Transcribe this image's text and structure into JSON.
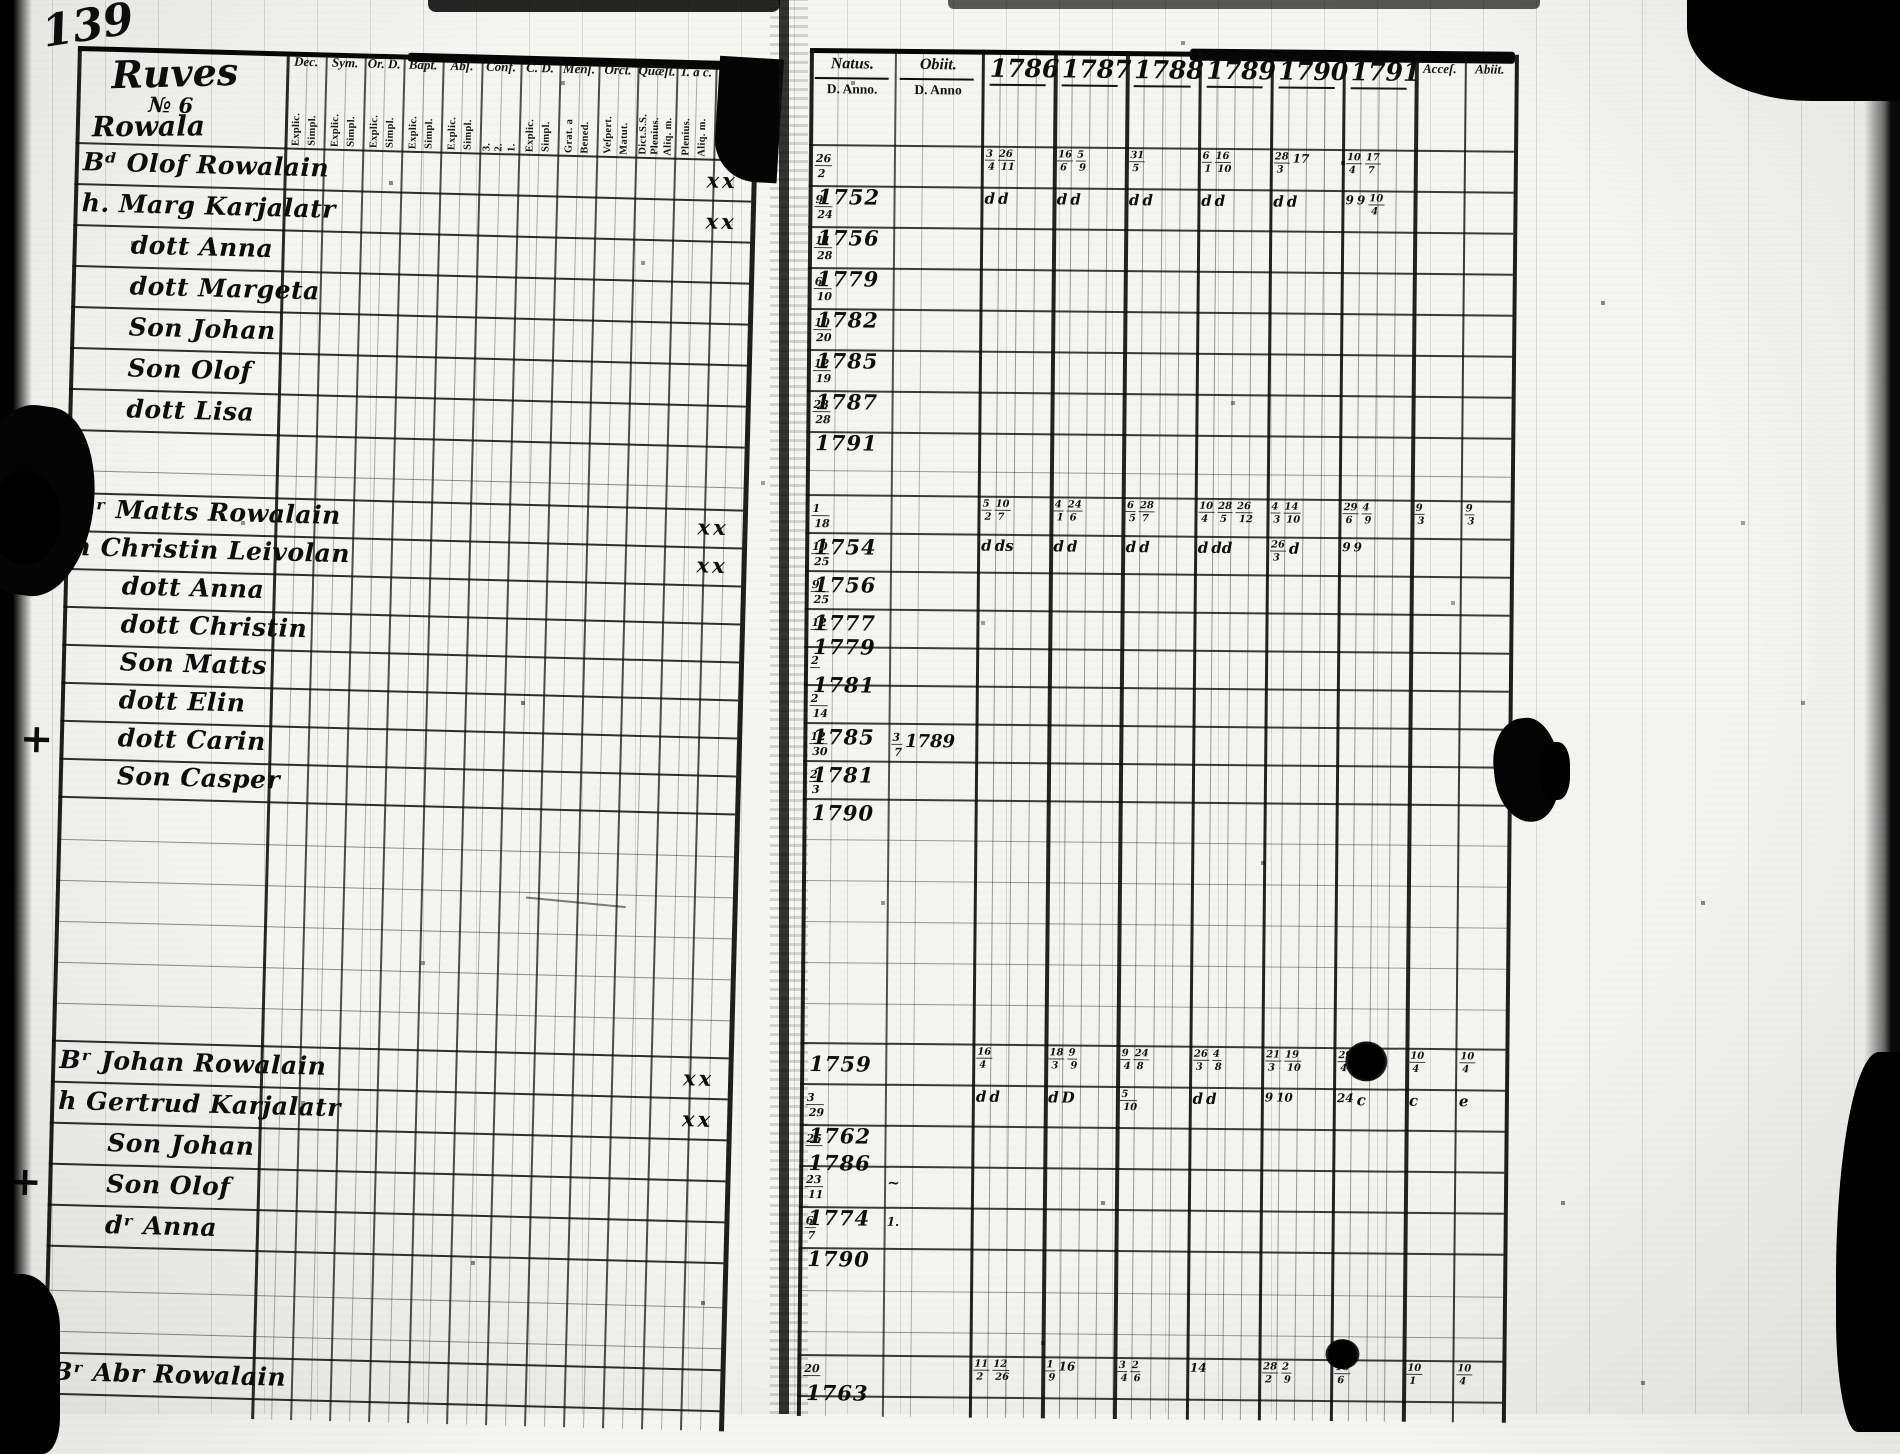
{
  "page_number": "139",
  "ink_color": "#111111",
  "paper_color": "#f5f5f2",
  "left_page": {
    "title": {
      "line1": "Ruves",
      "line2": "№ 6",
      "line3": "Rowala"
    },
    "columns": [
      {
        "label": "Dec.",
        "sub": [
          "Explic.",
          "Simpl."
        ]
      },
      {
        "label": "Sym.",
        "sub": [
          "Explic.",
          "Simpl."
        ]
      },
      {
        "label": "Or. D.",
        "sub": [
          "Explic.",
          "Simpl."
        ]
      },
      {
        "label": "Bapt.",
        "sub": [
          "Explic.",
          "Simpl."
        ]
      },
      {
        "label": "Abſ.",
        "sub": [
          "Explic.",
          "Simpl."
        ]
      },
      {
        "label": "Conf.",
        "sub": [
          "3.",
          "2.",
          "1."
        ]
      },
      {
        "label": "C. D.",
        "sub": [
          "Explic.",
          "Simpl."
        ]
      },
      {
        "label": "Menſ.",
        "sub": [
          "Grat. a",
          "Bened."
        ]
      },
      {
        "label": "Orct.",
        "sub": [
          "Veſpert.",
          "Matut."
        ]
      },
      {
        "label": "Quæſt.",
        "sub": [
          "Dict.S.S.",
          "Plenius.",
          "Aliq. m."
        ]
      },
      {
        "label": "T. a c.",
        "sub": [
          "Plenius.",
          "Aliq. m."
        ]
      },
      {
        "label": "L.",
        "sub": [
          "Exact.",
          "Aliq. m."
        ]
      }
    ]
  },
  "right_page": {
    "natus_label": "Natus.",
    "obiit_label": "Obiit.",
    "natus_sub": "D. Anno.",
    "obiit_sub": "D. Anno",
    "years": [
      "1786",
      "1787",
      "1788",
      "1789",
      "1790",
      "1791"
    ],
    "acces_label": "Acceſ.",
    "abiit_label": "Abiit."
  },
  "families": [
    {
      "rows": [
        {
          "prefix": "Bᵈ",
          "name": "Olof Rowalain",
          "indent": false,
          "xx": "xx",
          "natus": {
            "frac": "26/2",
            "year": "1752"
          },
          "years": {
            "1786": "3/4 26/11",
            "1787": "16/6 5/9",
            "1788": "31/5",
            "1789": "6/1 16/10",
            "1790": "28/3 17",
            "1791": "10/4 17/7"
          }
        },
        {
          "prefix": "h.",
          "name": "Marg Karjalatr",
          "indent": false,
          "xx": "xx",
          "natus": {
            "frac": "9/24",
            "year": "1756"
          },
          "years": {
            "1786": "d d",
            "1787": "d d",
            "1788": "d d",
            "1789": "d d",
            "1790": "d d",
            "1791": "9 9 10/4"
          }
        },
        {
          "prefix": "dott",
          "name": "Anna",
          "indent": true,
          "natus": {
            "frac": "11/28",
            "year": "1779"
          }
        },
        {
          "prefix": "dott",
          "name": "Margeta",
          "indent": true,
          "natus": {
            "frac": "6/10",
            "year": "1782"
          }
        },
        {
          "prefix": "Son",
          "name": "Johan",
          "indent": true,
          "natus": {
            "frac": "10/20",
            "year": "1785"
          }
        },
        {
          "prefix": "Son",
          "name": "Olof",
          "indent": true,
          "natus": {
            "frac": "12/19",
            "year": "1787"
          }
        },
        {
          "prefix": "dott",
          "name": "Lisa",
          "indent": true,
          "natus": {
            "frac": "23/28",
            "year": "1791"
          }
        }
      ]
    },
    {
      "rows": [
        {
          "prefix": "Bʳ",
          "name": "Matts Rowalain",
          "indent": false,
          "xx": "xx",
          "natus": {
            "frac": "1/18",
            "year": "1754"
          },
          "years": {
            "1786": "5/2 10/7",
            "1787": "4/1 24/6",
            "1788": "6/5 28/7",
            "1789": "10/4 28/5 26/12",
            "1790": "4/3 14/10",
            "1791": "29/6 4/9"
          },
          "acces": "9/3",
          "abiit": "9/3"
        },
        {
          "prefix": "h",
          "name": "Christin Leivolan",
          "indent": false,
          "xx": "xx",
          "natus": {
            "frac": "10/25",
            "year": "1756"
          },
          "years": {
            "1786": "d ds",
            "1787": "d d",
            "1788": "d d",
            "1789": "d dd",
            "1790": "26/3 d",
            "1791": "9 9"
          }
        },
        {
          "prefix": "dott",
          "name": "Anna",
          "indent": true,
          "natus": {
            "frac": "9/25",
            "year": "1777"
          }
        },
        {
          "prefix": "dott",
          "name": "Christin",
          "indent": true,
          "natus": {
            "frac": "12/",
            "year": "1779"
          }
        },
        {
          "prefix": "Son",
          "name": "Matts",
          "indent": true,
          "natus": {
            "frac": "2/",
            "year": "1781"
          }
        },
        {
          "prefix": "dott",
          "name": "Elin",
          "indent": true,
          "natus": {
            "frac": "2/14",
            "year": "1785"
          }
        },
        {
          "margin": "+",
          "prefix": "dott",
          "name": "Carin",
          "indent": true,
          "natus": {
            "frac": "12/30",
            "year": "1781"
          },
          "obiit": "3/7 1789"
        },
        {
          "prefix": "Son",
          "name": "Casper",
          "indent": true,
          "natus": {
            "frac": "2/3",
            "year": "1790"
          }
        }
      ]
    },
    {
      "rows": [
        {
          "prefix": "Bʳ",
          "name": "Johan Rowalain",
          "indent": false,
          "xx": "xx",
          "natus": {
            "frac": "",
            "year": "1759"
          },
          "years": {
            "1786": "16/4",
            "1787": "18/3 9/9",
            "1788": "9/4 24/8",
            "1789": "26/3 4/8",
            "1790": "21/3 19/10",
            "1791": "29/4 22/9"
          },
          "acces": "10/4",
          "abiit": "10/4"
        },
        {
          "prefix": "h",
          "name": "Gertrud Karjalatr",
          "indent": false,
          "xx": "xx",
          "natus": {
            "frac": "3/29",
            "year": "1762"
          },
          "years": {
            "1786": "d d",
            "1787": "d D",
            "1788": "5/10",
            "1789": "d d",
            "1790": "9 10",
            "1791": "24 c"
          },
          "acces": "c",
          "abiit": "e"
        },
        {
          "prefix": "Son",
          "name": "Johan",
          "indent": true,
          "natus": {
            "frac": "25/",
            "year": "1786"
          }
        },
        {
          "margin": "+",
          "prefix": "Son",
          "name": "Olof",
          "indent": true,
          "natus": {
            "frac": "23/11",
            "year": "1774"
          },
          "obiit": "~"
        },
        {
          "prefix": "dʳ",
          "name": "Anna",
          "indent": true,
          "natus": {
            "frac": "6/7",
            "year": "1790"
          },
          "obiit": "1."
        }
      ]
    },
    {
      "rows": [
        {
          "prefix": "Bʳ",
          "name": "Abr Rowalain",
          "indent": false,
          "natus": {
            "frac": "20/",
            "year": "1763"
          },
          "years": {
            "1786": "11/2 12/26",
            "1787": "1/9 16",
            "1788": "3/4 2/6",
            "1789": "14",
            "1790": "28/2 2/9",
            "1791": "16/6"
          },
          "acces": "10/1",
          "abiit": "10/4"
        }
      ]
    }
  ]
}
